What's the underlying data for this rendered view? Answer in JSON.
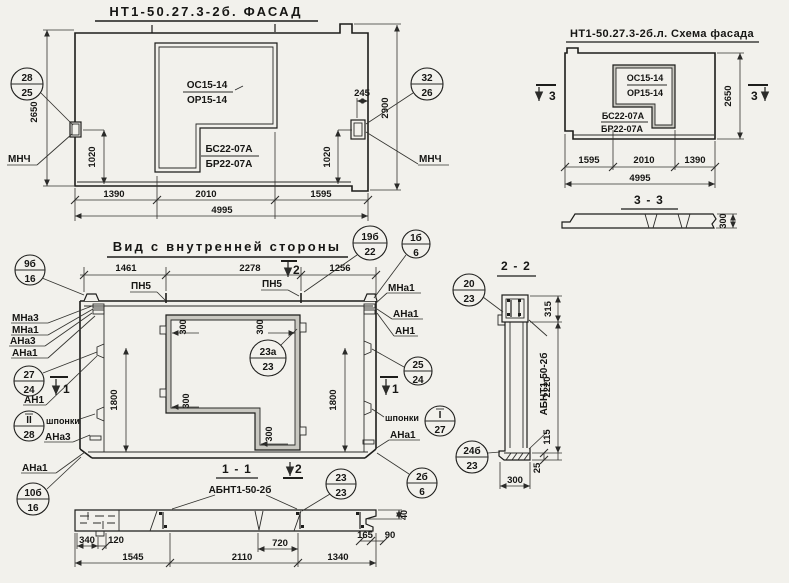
{
  "facade": {
    "title": "НТ1-50.27.3-2б. ФАСАД",
    "os": "ОС15-14",
    "or": "ОР15-14",
    "bs": "БС22-07А",
    "br": "БР22-07А",
    "mnch_left": "МНЧ",
    "mnch_right": "МНЧ",
    "d2650": "2650",
    "d2900": "2900",
    "d1020l": "1020",
    "d1020r": "1020",
    "d245": "245",
    "db1": "1390",
    "db2": "2010",
    "db3": "1595",
    "dtotal": "4995"
  },
  "schema": {
    "title": "НТ1-50.27.3-2б.л. Схема фасада",
    "os": "ОС15-14",
    "or": "ОР15-14",
    "bs": "БС22-07А",
    "br": "БР22-07А",
    "d2650": "2650",
    "db1": "1595",
    "db2": "2010",
    "db3": "1390",
    "dtotal": "4995"
  },
  "s33": {
    "title": "3 - 3",
    "d300": "300"
  },
  "inner": {
    "title": "Вид с внутренней стороны",
    "dt1": "1461",
    "dt2": "2278",
    "dt3": "1256",
    "pn5a": "ПН5",
    "pn5b": "ПН5",
    "left_labels": [
      "МНа3",
      "МНа1",
      "АНа3",
      "АНа1"
    ],
    "an1": "АН1",
    "shp_l": "шпонки",
    "ana3_bl": "АНа3",
    "ana1_bl": "АНа1",
    "right_labels": [
      "МНа1",
      "АНа1",
      "АН1"
    ],
    "shp_r": "шпонки",
    "ana1_br": "АНа1",
    "d1800l": "1800",
    "d1800r": "1800",
    "c300_1": "300",
    "c300_2": "300",
    "c300_3": "300",
    "c300_4": "300"
  },
  "s11": {
    "title": "1 - 1",
    "label": "АБНТ1-50-2б",
    "d340": "340",
    "d120": "120",
    "d1545": "1545",
    "d2110": "2110",
    "d720": "720",
    "d1340": "1340",
    "d165": "165",
    "d90": "90",
    "d40": "40"
  },
  "s22": {
    "title": "2 - 2",
    "label": "АБНТ1-50-2б",
    "d315": "315",
    "d2220": "2220",
    "d115": "115",
    "d25": "25",
    "d300": "300"
  },
  "cuts": {
    "c1": "1",
    "c2": "2",
    "c3": "3"
  },
  "callouts": {
    "c1": {
      "t": "28",
      "b": "25"
    },
    "c2": {
      "t": "32",
      "b": "26"
    },
    "c3": {
      "t": "9б",
      "b": "16"
    },
    "c4": {
      "t": "19б",
      "b": "22"
    },
    "c5": {
      "t": "1б",
      "b": "6"
    },
    "c6": {
      "t": "27",
      "b": "24"
    },
    "c7": {
      "t": "II",
      "b": "28"
    },
    "c8": {
      "t": "10б",
      "b": "16"
    },
    "c9": {
      "t": "23а",
      "b": "23"
    },
    "c10": {
      "t": "25",
      "b": "24"
    },
    "c11": {
      "t": "I",
      "b": "27"
    },
    "c12": {
      "t": "2б",
      "b": "6"
    },
    "c13": {
      "t": "24б",
      "b": "23"
    },
    "c14": {
      "t": "20",
      "b": "23"
    },
    "c15": {
      "t": "23",
      "b": "23"
    }
  }
}
